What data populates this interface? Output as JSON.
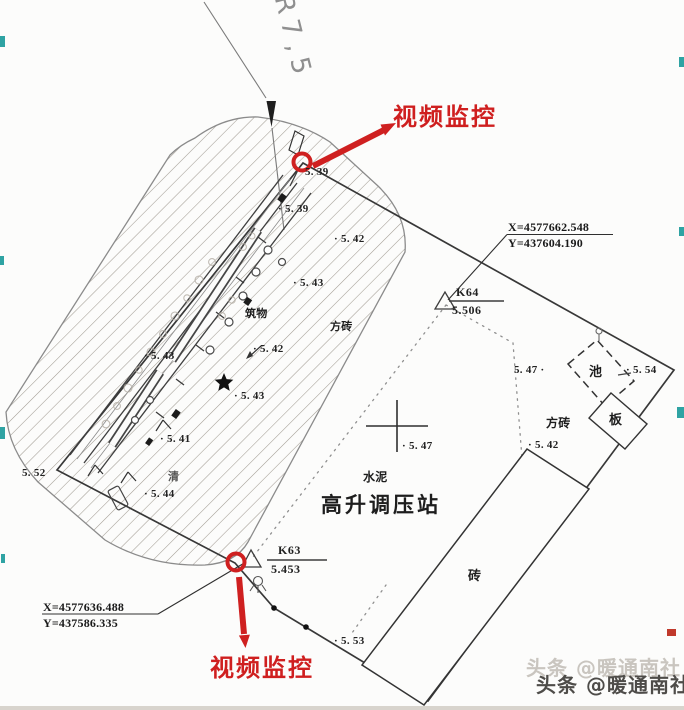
{
  "drawing": {
    "radius_label": "R7,5",
    "video_label_top": "视频监控",
    "video_label_bottom": "视频监控",
    "station_name": "高升调压站",
    "surface_labels": {
      "cement": "水泥",
      "brick_paving_inner": "方砖",
      "brick_paving_east": "方砖",
      "brick_building": "砖",
      "pool": "池",
      "board": "板",
      "structure": "筑物",
      "qing": "清"
    },
    "control_points": [
      {
        "id": "K64",
        "elevation": "5.506",
        "coord_x": "X=4577662.548",
        "coord_y": "Y=437604.190"
      },
      {
        "id": "K63",
        "elevation": "5.453",
        "coord_x": "X=4577636.488",
        "coord_y": "Y=437586.335"
      }
    ],
    "spot_elevations": [
      "5. 39",
      "· 5. 39",
      "· 5. 42",
      "· 5. 43",
      "· 5. 43",
      "· 5. 42",
      "· 5. 43",
      "· 5. 41",
      "5. 52",
      "· 5. 44",
      "· 5. 47",
      "5. 47 ·",
      "· 5. 54",
      "· 5. 42",
      "· 5. 53"
    ]
  },
  "watermark": {
    "main": "头条 @暖通南社",
    "shadow": "头条 @暖通南社"
  }
}
